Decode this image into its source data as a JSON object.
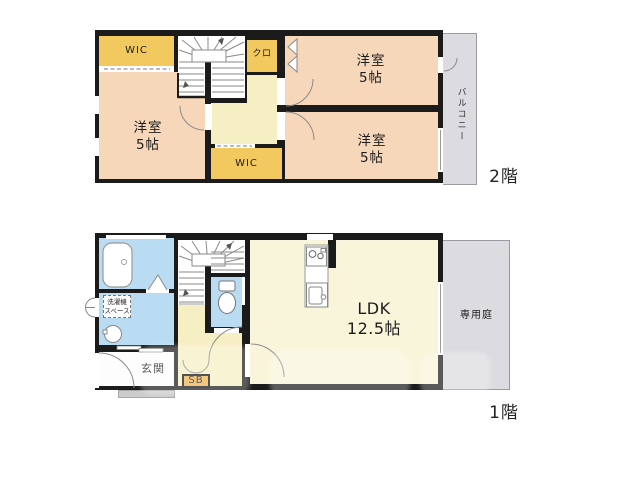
{
  "floor2": {
    "label": "2階",
    "balcony": "バルコニー",
    "wic_top": "WIC",
    "wic_bottom": "WIC",
    "closet": "クロ",
    "bedroom_left": {
      "name": "洋室",
      "size": "5帖"
    },
    "bedroom_top_right": {
      "name": "洋室",
      "size": "5帖"
    },
    "bedroom_bottom_right": {
      "name": "洋室",
      "size": "5帖"
    }
  },
  "floor1": {
    "label": "1階",
    "garden": "専用庭",
    "entrance": "玄関",
    "shoe_box": "SB",
    "laundry": {
      "line1": "洗濯機",
      "line2": "スペース"
    },
    "ldk": {
      "name": "LDK",
      "size": "12.5帖"
    }
  },
  "colors": {
    "wall": "#1b1b1b",
    "bedroom_peach": "#f6d7ba",
    "storage_yellow": "#f2c95f",
    "hall_cream": "#f6efc3",
    "ldk_cream": "#f8f5da",
    "wet_area_blue": "#b9dcf2",
    "outdoor_gray": "#dcdbe0",
    "shoe_box_orange": "#f2b04c"
  }
}
